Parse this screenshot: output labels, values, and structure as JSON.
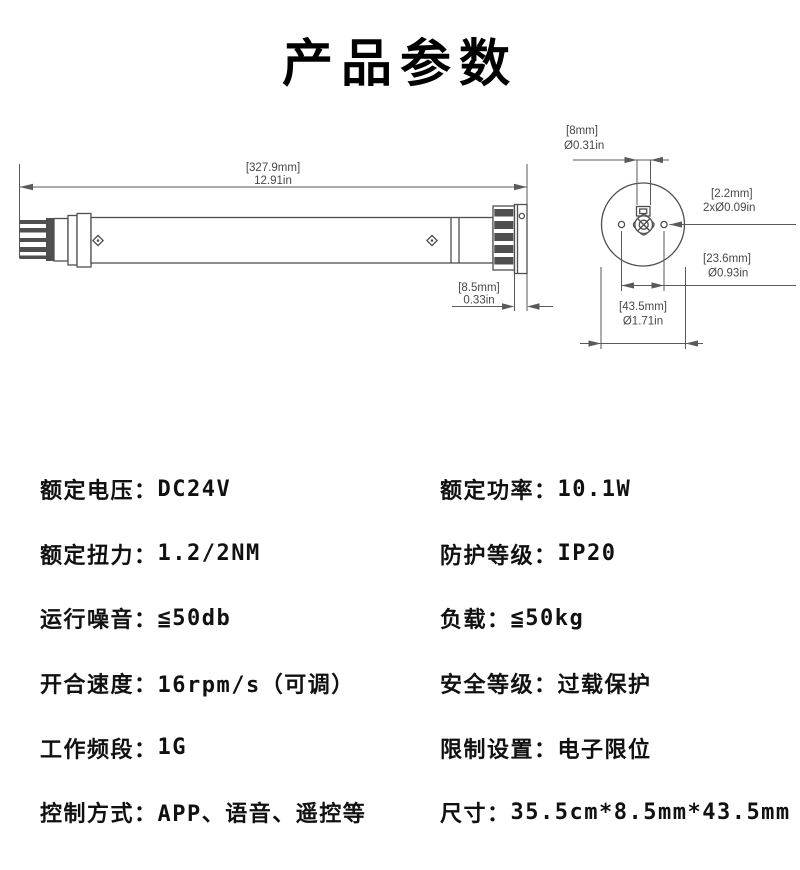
{
  "title": "产品参数",
  "side_view": {
    "length_mm": "[327.9mm]",
    "length_in": "12.91in",
    "head_mm": "[8.5mm]",
    "head_in": "0.33in"
  },
  "end_view": {
    "shaft_mm": "[8mm]",
    "shaft_in": "Ø0.31in",
    "holes_mm": "[2.2mm]",
    "holes_in": "2xØ0.09in",
    "pitch_mm": "[23.6mm]",
    "pitch_in": "Ø0.93in",
    "outer_mm": "[43.5mm]",
    "outer_in": "Ø1.71in"
  },
  "specs": {
    "left": [
      {
        "label": "额定电压：",
        "value": "DC24V"
      },
      {
        "label": "额定扭力：",
        "value": "1.2/2NM"
      },
      {
        "label": "运行噪音：",
        "value": "≦50db"
      },
      {
        "label": "开合速度：",
        "value": "16rpm/s（可调）"
      },
      {
        "label": "工作频段：",
        "value": "1G"
      },
      {
        "label": "控制方式：",
        "value": "APP、语音、遥控等"
      }
    ],
    "right": [
      {
        "label": "额定功率：",
        "value": "10.1W"
      },
      {
        "label": "防护等级：",
        "value": "IP20"
      },
      {
        "label": "负载：",
        "value": "≦50kg"
      },
      {
        "label": "安全等级：",
        "value": "过载保护"
      },
      {
        "label": "限制设置：",
        "value": "电子限位"
      },
      {
        "label": "尺寸：",
        "value": "35.5cm*8.5mm*43.5mm"
      }
    ]
  }
}
